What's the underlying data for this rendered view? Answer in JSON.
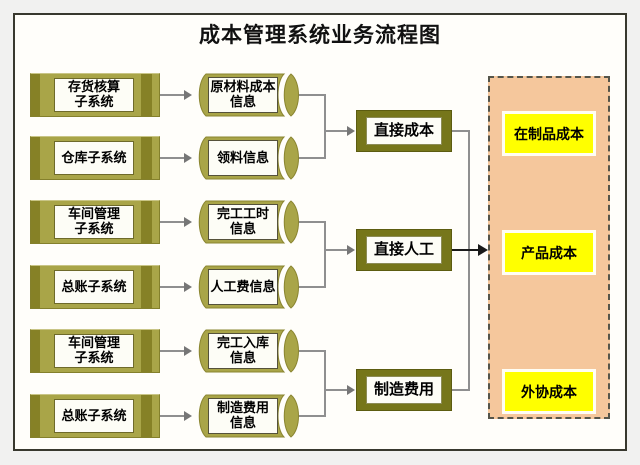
{
  "title": "成本管理系统业务流程图",
  "diagram": {
    "rows": [
      {
        "source": "存货核算\n子系统",
        "data_store": "原材料成本\n信息"
      },
      {
        "source": "仓库子系统",
        "data_store": "领料信息"
      },
      {
        "source": "车间管理\n子系统",
        "data_store": "完工工时\n信息"
      },
      {
        "source": "总账子系统",
        "data_store": "人工费信息"
      },
      {
        "source": "车间管理\n子系统",
        "data_store": "完工入库\n信息"
      },
      {
        "source": "总账子系统",
        "data_store": "制造费用\n信息"
      }
    ],
    "cost_nodes": [
      {
        "label": "直接成本"
      },
      {
        "label": "直接人工"
      },
      {
        "label": "制造费用"
      }
    ],
    "output_panel": {
      "items": [
        {
          "label": "在制品成本"
        },
        {
          "label": "产品成本"
        },
        {
          "label": "外协成本"
        }
      ]
    },
    "colors": {
      "khaki_fill": "#a9a548",
      "khaki_stripe": "#868126",
      "olive_fill": "#76761a",
      "peach_fill": "#f5c79c",
      "yellow_fill": "#ffff00",
      "panel_white": "#fdfdf6",
      "line_gray": "#8f8f8f",
      "line_black": "#1a1a1a",
      "frame_bg": "#fffefa"
    }
  }
}
